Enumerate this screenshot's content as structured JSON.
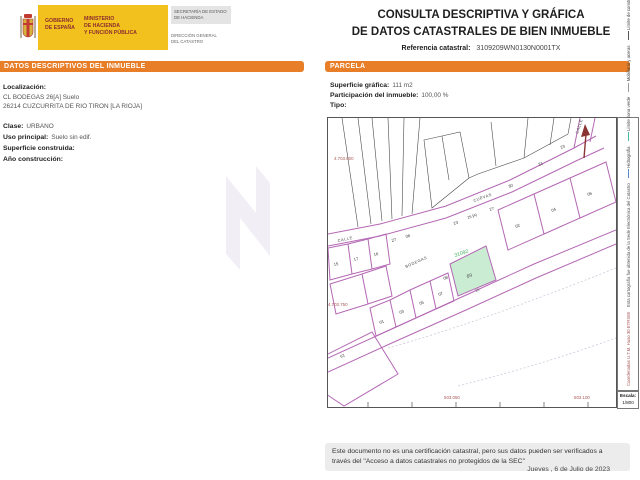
{
  "header": {
    "logo": {
      "gobierno_line1": "GOBIERNO",
      "gobierno_line2": "DE ESPAÑA",
      "ministerio_line1": "MINISTERIO",
      "ministerio_line2": "DE HACIENDA",
      "ministerio_line3": "Y FUNCIÓN PÚBLICA",
      "secretaria_line1": "SECRETARÍA DE ESTADO",
      "secretaria_line2": "DE HACIENDA",
      "direccion_line1": "DIRECCIÓN GENERAL",
      "direccion_line2": "DEL CATASTRO"
    },
    "title_line1": "CONSULTA DESCRIPTIVA Y GRÁFICA",
    "title_line2": "DE DATOS CATASTRALES DE BIEN INMUEBLE",
    "referencia_label": "Referencia catastral:",
    "referencia_value": "3109209WN0130N0001TX"
  },
  "datos_inmueble": {
    "section_title": "DATOS DESCRIPTIVOS DEL INMUEBLE",
    "localizacion_label": "Localización:",
    "localizacion_line1": "CL BODEGAS 26[A] Suelo",
    "localizacion_line2": "26214 CUZCURRITA DE RIO TIRON [LA RIOJA]",
    "clase_label": "Clase:",
    "clase_value": "URBANO",
    "uso_label": "Uso principal:",
    "uso_value": "Suelo sin edif.",
    "superficie_label": "Superficie construida:",
    "superficie_value": "",
    "anio_label": "Año construcción:",
    "anio_value": ""
  },
  "parcela": {
    "section_title": "PARCELA",
    "superficie_label": "Superficie gráfica:",
    "superficie_value": "111 m2",
    "participacion_label": "Participación del inmueble:",
    "participacion_value": "100,00 %",
    "tipo_label": "Tipo:",
    "tipo_value": ""
  },
  "map": {
    "highlight_parcel_id": "31092",
    "highlight_parcel_area": "69",
    "street_bodegas": "BODEGAS",
    "street_calle": "CALLE",
    "street_upper": "CUEVAS",
    "coord_top": "4.703.800",
    "coord_left": "4.703.750",
    "coord_bottom_left": "503.050",
    "coord_bottom_right": "503.100",
    "labels": [
      "15",
      "17",
      "16",
      "27",
      "06",
      "23",
      "25 [A]",
      "27",
      "30",
      "21",
      "23",
      "02",
      "04",
      "06",
      "01",
      "03",
      "05",
      "07",
      "08",
      "26",
      "61"
    ],
    "legend": [
      "Límite de parcela",
      "Límite de construcciones",
      "Mobiliario y aceras",
      "Límite zona verde",
      "Hidrografía"
    ],
    "legend_note": "Esta cartografía fue obtenida de la Sede Electrónica del Catastro",
    "legend_coords": "Coordenadas U.T.M. Huso 30 ETRS89",
    "escala_label": "Escala:",
    "escala_value": "1/800"
  },
  "footer": {
    "disclaimer_line1": "Este documento no es una certificación catastral, pero sus datos pueden ser verificados a",
    "disclaimer_line2": "través del \"Acceso a datos catastrales no protegidos de la SEC\"",
    "date": "Jueves , 6 de Julio de 2023"
  },
  "colors": {
    "accent_orange": "#E87E27",
    "banner_yellow": "#F2C11E",
    "parcel_line_magenta": "#B468B4",
    "highlight_fill_green": "#C9ECD2",
    "highlight_label_green": "#3FAE5C",
    "coordinate_red": "#A85858"
  }
}
